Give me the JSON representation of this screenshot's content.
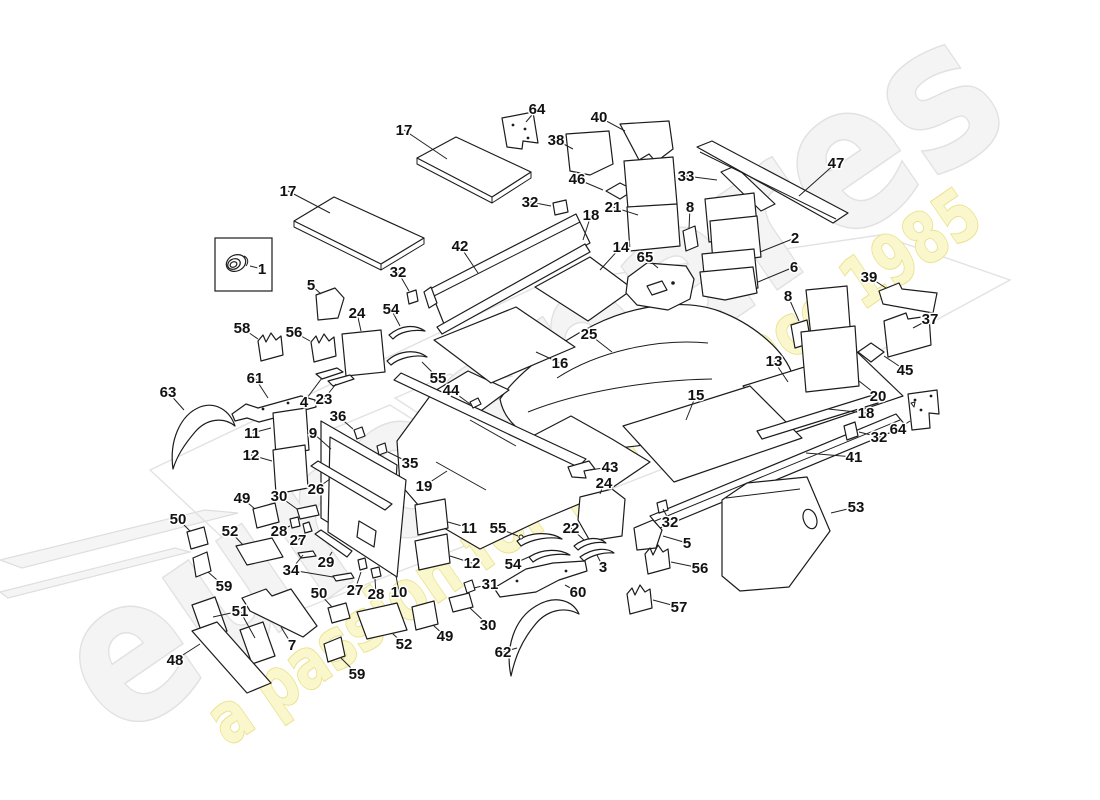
{
  "watermark": {
    "brand": "eurospares",
    "tagline": "a passion for parts since 1985",
    "brand_fill": "#f4f4f4",
    "brand_outline": "#e1e1e1",
    "tagline_fill": "#faf7cd",
    "tagline_outline": "#ebe18d"
  },
  "diagram": {
    "line_color": "#1c1c1c",
    "label_color": "#111111",
    "callouts": [
      {
        "t": "1",
        "x": 262,
        "y": 269,
        "l": [
          [
            250,
            266
          ]
        ]
      },
      {
        "t": "17",
        "x": 404,
        "y": 130,
        "l": [
          [
            447,
            159
          ]
        ]
      },
      {
        "t": "17",
        "x": 288,
        "y": 191,
        "l": [
          [
            330,
            213
          ]
        ]
      },
      {
        "t": "64",
        "x": 537,
        "y": 109,
        "l": [
          [
            526,
            122
          ]
        ]
      },
      {
        "t": "38",
        "x": 556,
        "y": 140,
        "l": [
          [
            573,
            149
          ]
        ]
      },
      {
        "t": "40",
        "x": 599,
        "y": 117,
        "l": [
          [
            625,
            131
          ]
        ]
      },
      {
        "t": "32",
        "x": 530,
        "y": 202,
        "l": [
          [
            551,
            206
          ]
        ]
      },
      {
        "t": "46",
        "x": 577,
        "y": 179,
        "l": [
          [
            603,
            190
          ]
        ]
      },
      {
        "t": "18",
        "x": 591,
        "y": 215,
        "l": [
          [
            583,
            240
          ]
        ]
      },
      {
        "t": "21",
        "x": 613,
        "y": 207,
        "l": [
          [
            638,
            215
          ]
        ]
      },
      {
        "t": "33",
        "x": 686,
        "y": 176,
        "l": [
          [
            717,
            180
          ]
        ]
      },
      {
        "t": "47",
        "x": 836,
        "y": 163,
        "l": [
          [
            799,
            196
          ]
        ]
      },
      {
        "t": "8",
        "x": 690,
        "y": 207,
        "l": [
          [
            689,
            229
          ]
        ]
      },
      {
        "t": "2",
        "x": 795,
        "y": 238,
        "l": [
          [
            760,
            252
          ]
        ]
      },
      {
        "t": "6",
        "x": 794,
        "y": 267,
        "l": [
          [
            758,
            282
          ]
        ]
      },
      {
        "t": "8",
        "x": 788,
        "y": 296,
        "l": [
          [
            799,
            321
          ]
        ]
      },
      {
        "t": "39",
        "x": 869,
        "y": 277,
        "l": [
          [
            886,
            288
          ]
        ]
      },
      {
        "t": "42",
        "x": 460,
        "y": 246,
        "l": [
          [
            478,
            273
          ]
        ]
      },
      {
        "t": "32",
        "x": 398,
        "y": 272,
        "l": [
          [
            409,
            291
          ]
        ]
      },
      {
        "t": "14",
        "x": 621,
        "y": 247,
        "l": [
          [
            600,
            270
          ]
        ]
      },
      {
        "t": "65",
        "x": 645,
        "y": 257,
        "l": [
          [
            658,
            268
          ]
        ]
      },
      {
        "t": "5",
        "x": 311,
        "y": 285,
        "l": [
          [
            321,
            294
          ]
        ]
      },
      {
        "t": "24",
        "x": 357,
        "y": 313,
        "l": [
          [
            361,
            331
          ]
        ]
      },
      {
        "t": "54",
        "x": 391,
        "y": 309,
        "l": [
          [
            400,
            326
          ]
        ]
      },
      {
        "t": "58",
        "x": 242,
        "y": 328,
        "l": [
          [
            258,
            339
          ]
        ]
      },
      {
        "t": "56",
        "x": 294,
        "y": 332,
        "l": [
          [
            310,
            341
          ]
        ]
      },
      {
        "t": "37",
        "x": 930,
        "y": 319,
        "l": [
          [
            913,
            328
          ]
        ]
      },
      {
        "t": "45",
        "x": 905,
        "y": 370,
        "l": [
          [
            884,
            356
          ]
        ]
      },
      {
        "t": "20",
        "x": 878,
        "y": 396,
        "l": [
          [
            859,
            381
          ]
        ]
      },
      {
        "t": "13",
        "x": 774,
        "y": 361,
        "l": [
          [
            788,
            382
          ]
        ]
      },
      {
        "t": "15",
        "x": 696,
        "y": 395,
        "l": [
          [
            686,
            420
          ]
        ]
      },
      {
        "t": "25",
        "x": 589,
        "y": 334,
        "l": [
          [
            612,
            352
          ]
        ]
      },
      {
        "t": "16",
        "x": 560,
        "y": 363,
        "l": [
          [
            536,
            352
          ]
        ]
      },
      {
        "t": "61",
        "x": 255,
        "y": 378,
        "l": [
          [
            268,
            398
          ]
        ]
      },
      {
        "t": "4",
        "x": 304,
        "y": 402,
        "l": [
          [
            322,
            378
          ]
        ]
      },
      {
        "t": "23",
        "x": 324,
        "y": 399,
        "l": [
          [
            336,
            384
          ]
        ]
      },
      {
        "t": "55",
        "x": 438,
        "y": 378,
        "l": [
          [
            422,
            362
          ]
        ]
      },
      {
        "t": "44",
        "x": 451,
        "y": 390,
        "l": [
          [
            470,
            404
          ]
        ]
      },
      {
        "t": "63",
        "x": 168,
        "y": 392,
        "l": [
          [
            184,
            410
          ]
        ]
      },
      {
        "t": "36",
        "x": 338,
        "y": 416,
        "l": [
          [
            353,
            429
          ]
        ]
      },
      {
        "t": "9",
        "x": 313,
        "y": 433,
        "l": [
          [
            331,
            449
          ]
        ]
      },
      {
        "t": "11",
        "x": 252,
        "y": 433,
        "l": [
          [
            271,
            428
          ]
        ]
      },
      {
        "t": "12",
        "x": 251,
        "y": 455,
        "l": [
          [
            272,
            461
          ]
        ]
      },
      {
        "t": "35",
        "x": 410,
        "y": 463,
        "l": [
          [
            388,
            452
          ]
        ]
      },
      {
        "t": "26",
        "x": 316,
        "y": 489,
        "l": [
          [
            330,
            479
          ]
        ]
      },
      {
        "t": "19",
        "x": 424,
        "y": 486,
        "l": [
          [
            447,
            471
          ]
        ]
      },
      {
        "t": "43",
        "x": 610,
        "y": 467,
        "l": [
          [
            590,
            470
          ]
        ]
      },
      {
        "t": "24",
        "x": 604,
        "y": 483,
        "l": [
          [
            600,
            494
          ]
        ]
      },
      {
        "t": "18",
        "x": 866,
        "y": 413,
        "l": [
          [
            828,
            409
          ]
        ]
      },
      {
        "t": "32",
        "x": 879,
        "y": 437,
        "l": [
          [
            859,
            432
          ]
        ]
      },
      {
        "t": "64",
        "x": 898,
        "y": 429,
        "l": [
          [
            910,
            421
          ]
        ]
      },
      {
        "t": "41",
        "x": 854,
        "y": 457,
        "l": [
          [
            806,
            453
          ]
        ]
      },
      {
        "t": "53",
        "x": 856,
        "y": 507,
        "l": [
          [
            831,
            513
          ]
        ]
      },
      {
        "t": "32",
        "x": 670,
        "y": 522,
        "l": [
          [
            663,
            509
          ]
        ]
      },
      {
        "t": "5",
        "x": 687,
        "y": 543,
        "l": [
          [
            663,
            536
          ]
        ]
      },
      {
        "t": "56",
        "x": 700,
        "y": 568,
        "l": [
          [
            671,
            562
          ]
        ]
      },
      {
        "t": "57",
        "x": 679,
        "y": 607,
        "l": [
          [
            653,
            600
          ]
        ]
      },
      {
        "t": "22",
        "x": 571,
        "y": 528,
        "l": [
          [
            584,
            540
          ]
        ]
      },
      {
        "t": "3",
        "x": 603,
        "y": 567,
        "l": [
          [
            597,
            555
          ]
        ]
      },
      {
        "t": "55",
        "x": 498,
        "y": 528,
        "l": [
          [
            518,
            536
          ]
        ]
      },
      {
        "t": "54",
        "x": 513,
        "y": 564,
        "l": [
          [
            531,
            556
          ]
        ]
      },
      {
        "t": "60",
        "x": 578,
        "y": 592,
        "l": [
          [
            565,
            585
          ]
        ]
      },
      {
        "t": "31",
        "x": 490,
        "y": 584,
        "l": [
          [
            474,
            588
          ]
        ]
      },
      {
        "t": "30",
        "x": 488,
        "y": 625,
        "l": [
          [
            470,
            608
          ]
        ]
      },
      {
        "t": "62",
        "x": 503,
        "y": 652,
        "l": [
          [
            517,
            648
          ]
        ]
      },
      {
        "t": "49",
        "x": 445,
        "y": 636,
        "l": [
          [
            433,
            625
          ]
        ]
      },
      {
        "t": "52",
        "x": 404,
        "y": 644,
        "l": [
          [
            393,
            634
          ]
        ]
      },
      {
        "t": "59",
        "x": 357,
        "y": 674,
        "l": [
          [
            341,
            658
          ]
        ]
      },
      {
        "t": "10",
        "x": 399,
        "y": 592,
        "l": [
          [
            396,
            576
          ]
        ]
      },
      {
        "t": "27",
        "x": 355,
        "y": 590,
        "l": [
          [
            361,
            572
          ]
        ]
      },
      {
        "t": "28",
        "x": 376,
        "y": 594,
        "l": [
          [
            375,
            579
          ]
        ]
      },
      {
        "t": "50",
        "x": 319,
        "y": 593,
        "l": [
          [
            332,
            607
          ]
        ]
      },
      {
        "t": "34",
        "x": 291,
        "y": 570,
        "l": [
          [
            303,
            555
          ],
          [
            333,
            577
          ]
        ]
      },
      {
        "t": "29",
        "x": 326,
        "y": 562,
        "l": [
          [
            332,
            552
          ]
        ]
      },
      {
        "t": "27",
        "x": 298,
        "y": 540,
        "l": [
          [
            305,
            533
          ]
        ]
      },
      {
        "t": "28",
        "x": 279,
        "y": 531,
        "l": [
          [
            290,
            526
          ]
        ]
      },
      {
        "t": "52",
        "x": 230,
        "y": 531,
        "l": [
          [
            243,
            545
          ]
        ]
      },
      {
        "t": "50",
        "x": 178,
        "y": 519,
        "l": [
          [
            190,
            531
          ]
        ]
      },
      {
        "t": "49",
        "x": 242,
        "y": 498,
        "l": [
          [
            255,
            509
          ]
        ]
      },
      {
        "t": "30",
        "x": 279,
        "y": 496,
        "l": [
          [
            297,
            509
          ]
        ]
      },
      {
        "t": "11",
        "x": 469,
        "y": 528,
        "l": [
          [
            448,
            522
          ]
        ]
      },
      {
        "t": "12",
        "x": 472,
        "y": 563,
        "l": [
          [
            450,
            556
          ]
        ]
      },
      {
        "t": "59",
        "x": 224,
        "y": 586,
        "l": [
          [
            208,
            572
          ]
        ]
      },
      {
        "t": "51",
        "x": 240,
        "y": 611,
        "l": [
          [
            213,
            617
          ],
          [
            255,
            638
          ]
        ]
      },
      {
        "t": "7",
        "x": 292,
        "y": 645,
        "l": [
          [
            281,
            627
          ]
        ]
      },
      {
        "t": "48",
        "x": 175,
        "y": 660,
        "l": [
          [
            200,
            644
          ]
        ]
      }
    ]
  }
}
